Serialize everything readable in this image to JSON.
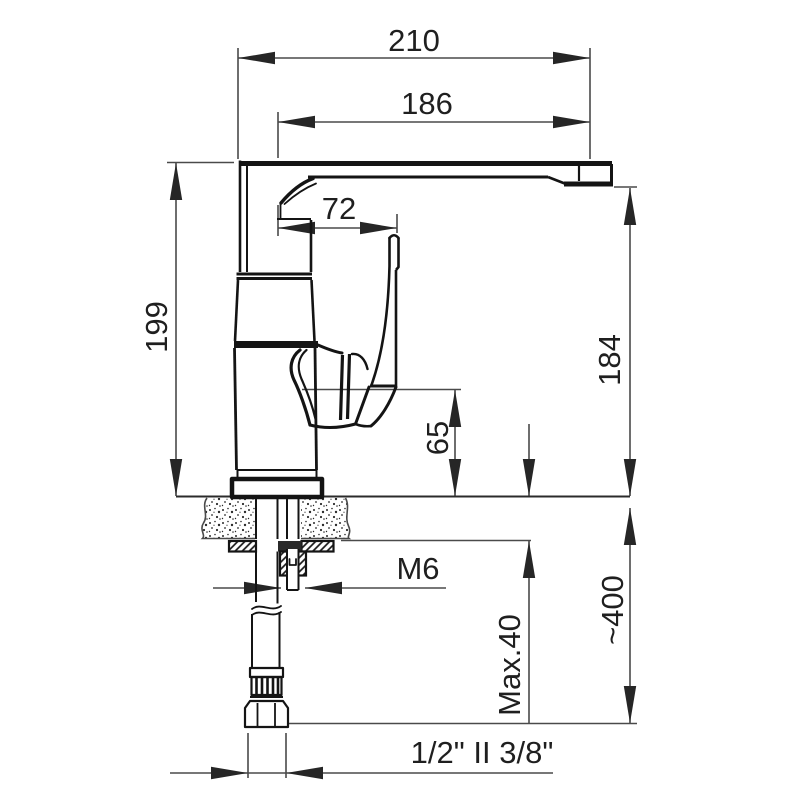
{
  "drawing": {
    "background": "#ffffff",
    "line_color": "#141414",
    "dim_line_color": "#4a4a4a",
    "text_color": "#1f1f1f",
    "dimensions": {
      "total_width": "210",
      "spout_reach": "186",
      "handle_reach": "72",
      "total_height": "199",
      "spout_height": "184",
      "body_height": "65",
      "thread_size": "M6",
      "max_mount_thickness": "Max.40",
      "hose_length": "~400",
      "connection_size": "1/2\" II 3/8\""
    }
  }
}
